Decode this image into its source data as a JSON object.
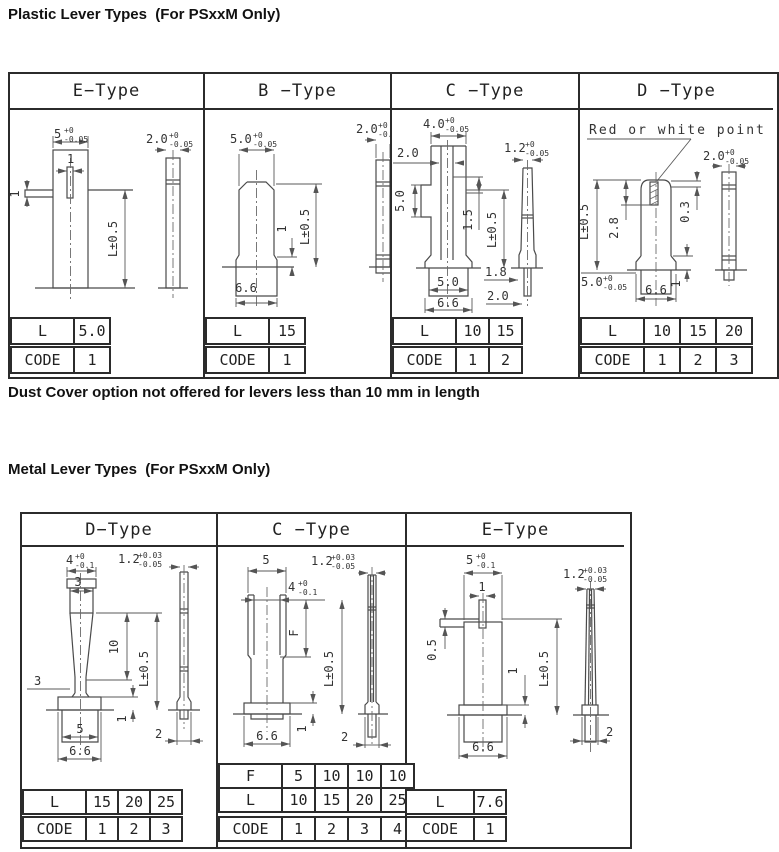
{
  "page": {
    "title_plastic": "Plastic Lever Types  (For PSxxM Only)",
    "note": "Dust Cover option not offered for levers less than 10 mm in length",
    "title_metal": "Metal Lever Types  (For PSxxM Only)"
  },
  "plastic": {
    "headers": [
      "E−Type",
      "B −Type",
      "C −Type",
      "D −Type"
    ],
    "e": {
      "dim_top": "5",
      "dim_top_sup": "+0",
      "dim_top_sub": "-0.05",
      "dim_slot": "1",
      "dim_tab": "1",
      "dim_len": "L±0.5",
      "dim_side": "2.0",
      "dim_side_sup": "+0",
      "dim_side_sub": "-0.05",
      "l_label": "L",
      "l": [
        "5.0"
      ],
      "code_label": "CODE",
      "code": [
        "1"
      ]
    },
    "b": {
      "dim_top": "5.0",
      "dim_top_sup": "+0",
      "dim_top_sub": "-0.05",
      "dim_side": "2.0",
      "dim_side_sup": "+0",
      "dim_side_sub": "-0.05",
      "dim_step": "1",
      "dim_len": "L±0.5",
      "dim_base": "6.6",
      "l_label": "L",
      "l": [
        "15"
      ],
      "code_label": "CODE",
      "code": [
        "1"
      ]
    },
    "c": {
      "dim_top": "4.0",
      "dim_top_sup": "+0",
      "dim_top_sub": "-0.05",
      "dim_inner": "2.0",
      "dim_side": "1.2",
      "dim_side_sup": "+0",
      "dim_side_sub": "-0.05",
      "dim_left": "5.0",
      "dim_mid": "1.5",
      "dim_len": "L±0.5",
      "dim_t1": "1.8",
      "dim_t2": "2.0",
      "dim_base_inner": "5.0",
      "dim_base": "6.6",
      "l_label": "L",
      "l": [
        "10",
        "15"
      ],
      "code_label": "CODE",
      "code": [
        "1",
        "2"
      ]
    },
    "d": {
      "callout": "Red or white point",
      "dim_side": "2.0",
      "dim_side_sup": "+0",
      "dim_side_sub": "-0.05",
      "dim_len": "L±0.5",
      "dim_mark": "2.8",
      "dim_crown": "0.3",
      "dim_w": "5.0",
      "dim_w_sup": "+0",
      "dim_w_sub": "-0.05",
      "dim_step": "1",
      "dim_base": "6.6",
      "l_label": "L",
      "l": [
        "10",
        "15",
        "20"
      ],
      "code_label": "CODE",
      "code": [
        "1",
        "2",
        "3"
      ]
    }
  },
  "metal": {
    "headers": [
      "D−Type",
      "C −Type",
      "E−Type"
    ],
    "d": {
      "dim_top": "4",
      "dim_top_sup": "+0",
      "dim_top_sub": "-0.1",
      "dim_tip": "3",
      "dim_side": "1.2",
      "dim_side_sup": "+0.03",
      "dim_side_sub": "-0.05",
      "dim_taper": "10",
      "dim_len": "L±0.5",
      "dim_shank": "3",
      "dim_base_inner": "5",
      "dim_base": "6.6",
      "dim_step": "1",
      "dim_side_base": "2",
      "l_label": "L",
      "l": [
        "15",
        "20",
        "25"
      ],
      "code_label": "CODE",
      "code": [
        "1",
        "2",
        "3"
      ]
    },
    "c": {
      "dim_top": "5",
      "dim_side": "1.2",
      "dim_side_sup": "+0.03",
      "dim_side_sub": "-0.05",
      "dim_notch": "4",
      "dim_notch_sup": "+0",
      "dim_notch_sub": "-0.1",
      "dim_f": "F",
      "dim_len": "L±0.5",
      "dim_base": "6.6",
      "dim_step": "1",
      "dim_side_base": "2",
      "f_label": "F",
      "f": [
        "5",
        "10",
        "10",
        "10"
      ],
      "l_label": "L",
      "l": [
        "10",
        "15",
        "20",
        "25"
      ],
      "code_label": "CODE",
      "code": [
        "1",
        "2",
        "3",
        "4"
      ]
    },
    "e": {
      "dim_top": "5",
      "dim_top_sup": "+0",
      "dim_top_sub": "-0.1",
      "dim_pin": "1",
      "dim_left": "0.5",
      "dim_side": "1.2",
      "dim_side_sup": "+0.03",
      "dim_side_sub": "-0.05",
      "dim_len": "L±0.5",
      "dim_mid": "1",
      "dim_base": "6.6",
      "dim_side_base": "2",
      "l_label": "L",
      "l": [
        "7.6"
      ],
      "code_label": "CODE",
      "code": [
        "1"
      ]
    }
  }
}
